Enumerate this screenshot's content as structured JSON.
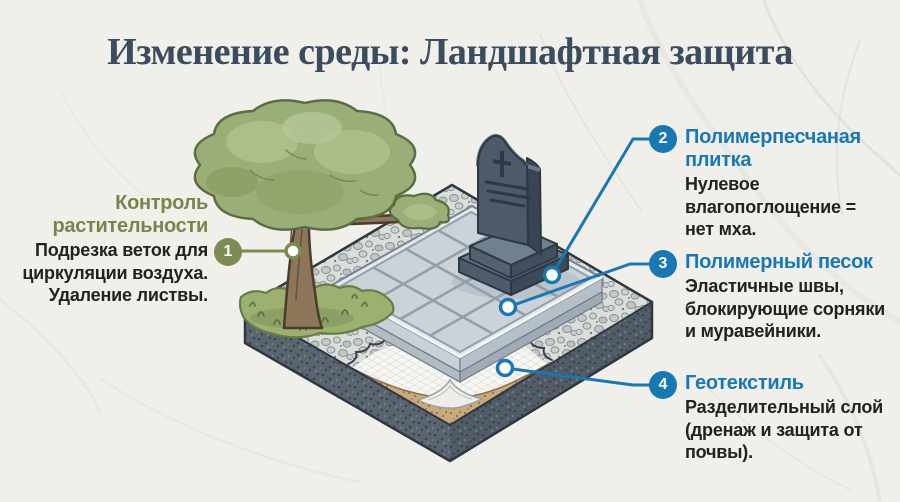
{
  "header": {
    "title": "Изменение среды: Ландшафтная защита"
  },
  "colors": {
    "accent_blue": "#1878b4",
    "accent_green": "#7c8b52",
    "title_color": "#3a4c5e",
    "body_text": "#22231f",
    "background": "#f1efe9"
  },
  "callouts": {
    "vegetation": {
      "number": "1",
      "title_lines": [
        "Контроль",
        "растительности"
      ],
      "body_lines": [
        "Подрезка веток для",
        "циркуляции воздуха.",
        "Удаление листвы."
      ]
    },
    "tile": {
      "number": "2",
      "title_lines": [
        "Полимерпесчаная",
        "плитка"
      ],
      "body_lines": [
        "Нулевое",
        "влагопоглощение =",
        "нет мха."
      ]
    },
    "sand": {
      "number": "3",
      "title_lines": [
        "Полимерный песок"
      ],
      "body_lines": [
        "Эластичные швы,",
        "блокирующие сорняки",
        "и муравейники."
      ]
    },
    "geotextile": {
      "number": "4",
      "title_lines": [
        "Геотекстиль"
      ],
      "body_lines": [
        "Разделительный слой",
        "(дренаж и защита от",
        "почвы)."
      ]
    }
  },
  "illustration": {
    "elements": [
      "tree",
      "grass-mound",
      "headstone-monument",
      "paving-tiles",
      "gravel-border",
      "geotextile-layer",
      "sand-layer",
      "soil-block"
    ]
  }
}
